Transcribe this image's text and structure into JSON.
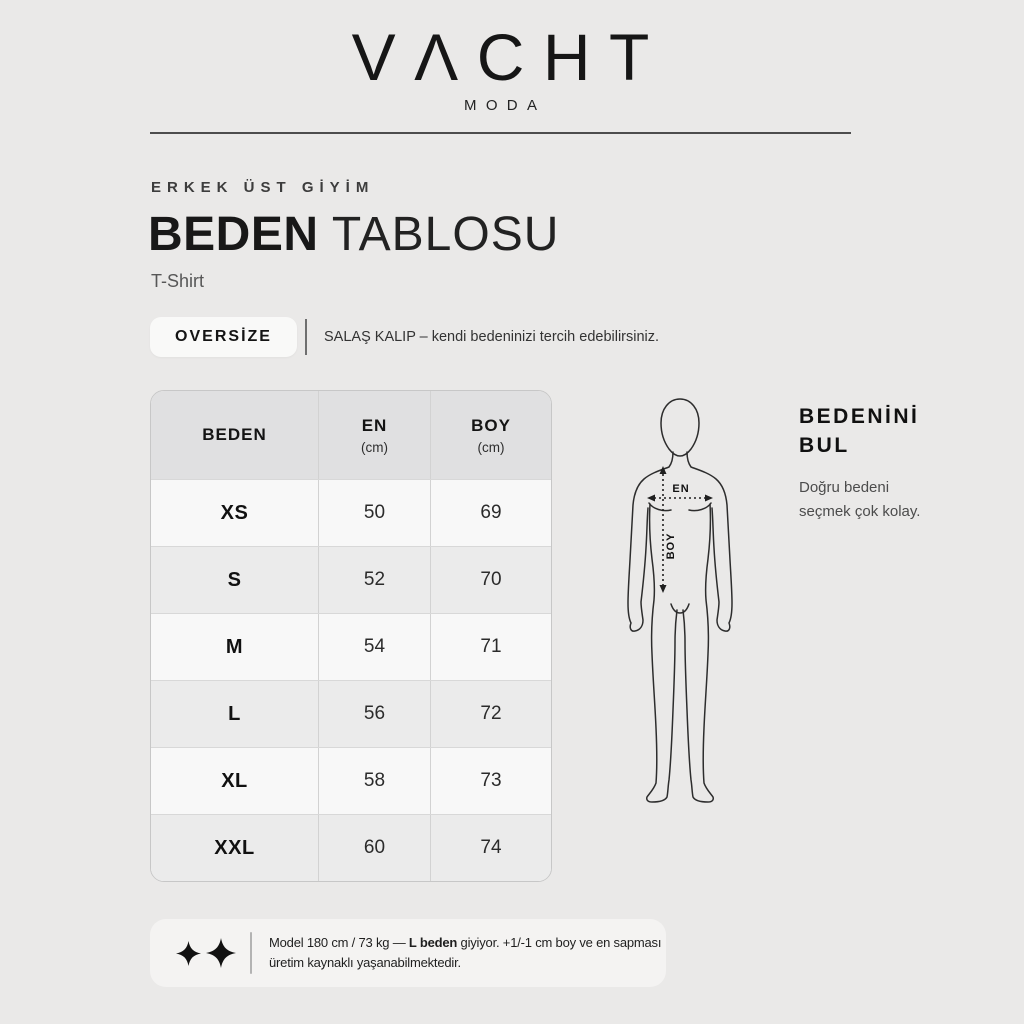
{
  "brand": {
    "logo": "VΛCHT",
    "sub": "MODA"
  },
  "header": {
    "eyebrow": "ERKEK ÜST GİYİM",
    "title_bold": "BEDEN",
    "title_light": "TABLOSU",
    "subtitle": "T-Shirt"
  },
  "fit": {
    "badge": "OVERSİZE",
    "description": "SALAŞ KALIP – kendi bedeninizi tercih edebilirsiniz."
  },
  "size_table": {
    "columns": [
      {
        "label": "BEDEN",
        "unit": ""
      },
      {
        "label": "EN",
        "unit": "(cm)"
      },
      {
        "label": "BOY",
        "unit": "(cm)"
      }
    ],
    "rows": [
      {
        "size": "XS",
        "en": "50",
        "boy": "69"
      },
      {
        "size": "S",
        "en": "52",
        "boy": "70"
      },
      {
        "size": "M",
        "en": "54",
        "boy": "71"
      },
      {
        "size": "L",
        "en": "56",
        "boy": "72"
      },
      {
        "size": "XL",
        "en": "58",
        "boy": "73"
      },
      {
        "size": "XXL",
        "en": "60",
        "boy": "74"
      }
    ]
  },
  "figure": {
    "en_label": "EN",
    "boy_label": "BOY"
  },
  "guide": {
    "title_line1": "BEDENİNİ",
    "title_line2": "BUL",
    "text_line1": "Doğru bedeni",
    "text_line2": "seçmek çok kolay."
  },
  "note": {
    "sparkle_icon": "✦",
    "line1_pre": "Model 180 cm / 73 kg — ",
    "line1_bold": "L beden",
    "line1_post": " giyiyor. +1/-1 cm boy ve en sapması",
    "line2": "üretim kaynaklı yaşanabilmektedir."
  },
  "colors": {
    "page_bg": "#eae9e8",
    "table_header_bg": "#e0e0e1",
    "row_light": "#f8f8f8",
    "row_dark": "#ebebeb",
    "ink": "#1c1c1c",
    "figure_stroke": "#2d2d2d"
  }
}
